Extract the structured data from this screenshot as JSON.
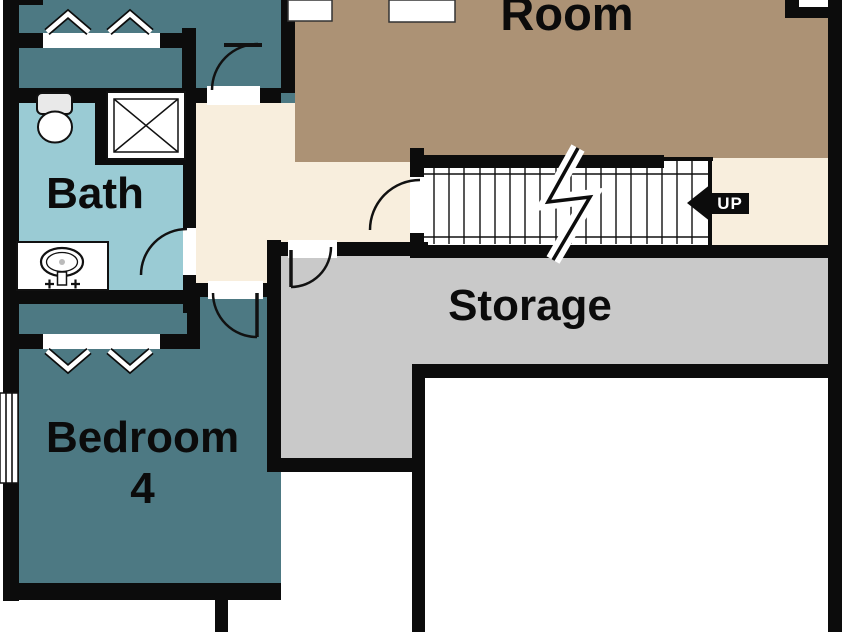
{
  "floor_plan": {
    "rooms": {
      "great_room": {
        "label": "Room",
        "floor_color": "#ac9275"
      },
      "bath": {
        "label": "Bath",
        "floor_color": "#9acbd4"
      },
      "storage": {
        "label": "Storage",
        "floor_color": "#c9c9c9"
      },
      "bedroom4": {
        "label_line1": "Bedroom",
        "label_line2": "4",
        "floor_color": "#4d7983"
      },
      "upper_bedroom_area": {
        "floor_color": "#4d7983"
      },
      "hallway": {
        "floor_color": "#f8eedd"
      },
      "unfinished_room": {
        "floor_color": "#ffffff"
      }
    },
    "stairs": {
      "direction_label": "UP",
      "arrow_color": "#0c0c0c",
      "label_color": "#ffffff"
    },
    "structure": {
      "wall_color": "#0c0c0c",
      "fixture_outline_color": "#111111",
      "fixtures": [
        "toilet",
        "shower",
        "sink-vanity",
        "bifold-closet-doors",
        "window",
        "door-swings",
        "stair-break-line"
      ]
    }
  }
}
